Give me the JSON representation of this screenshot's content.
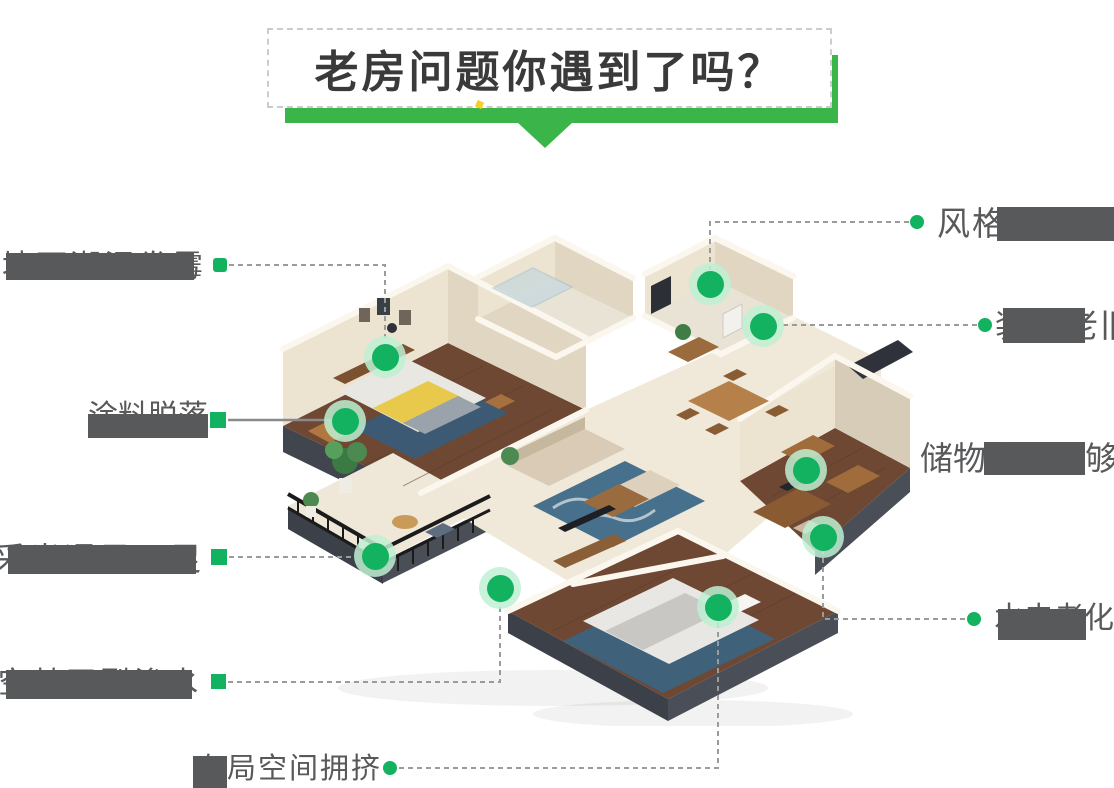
{
  "title": {
    "text": "老房问题你遇到了吗？"
  },
  "callouts": [
    {
      "id": "wall-mildew",
      "text": "墙面潮湿发霉",
      "visible_text": "霉",
      "state": "mostly-masked"
    },
    {
      "id": "paint-peeling",
      "text": "涂料脱落",
      "visible_text": "涂料脱落",
      "state": "bottom-half-masked"
    },
    {
      "id": "poor-lighting",
      "text": "采光通风不足",
      "visible_text": "采",
      "state": "mostly-masked"
    },
    {
      "id": "hollow-crack-seepage",
      "text": "空鼓开裂渗水",
      "visible_text": "空…水",
      "state": "mostly-masked"
    },
    {
      "id": "crowded-layout",
      "text": "布局空间拥挤",
      "visible_text": "布局空间拥挤",
      "state": "first-char-masked"
    },
    {
      "id": "outdated-style",
      "text": "风格过时",
      "visible_text": "风格",
      "state": "tail-masked"
    },
    {
      "id": "old-decoration",
      "text": "装修老旧",
      "visible_text": "旧",
      "state": "middle-masked"
    },
    {
      "id": "insufficient-storage",
      "text": "储物空间不够",
      "visible_text": "储物…够",
      "state": "middle-masked"
    },
    {
      "id": "aging-plumbing-wiring",
      "text": "水电老化",
      "visible_text": "化",
      "state": "mostly-masked"
    }
  ],
  "markers": [
    {
      "id": "bedroom-wall-spot",
      "x": 385,
      "y": 357
    },
    {
      "id": "bedroom-bedside-spot",
      "x": 345,
      "y": 421
    },
    {
      "id": "utility-room-spot",
      "x": 710,
      "y": 284
    },
    {
      "id": "entry-bath-spot",
      "x": 763,
      "y": 326
    },
    {
      "id": "bookshelf-spot",
      "x": 806,
      "y": 470
    },
    {
      "id": "study-desk-spot",
      "x": 823,
      "y": 537
    },
    {
      "id": "balcony-spot",
      "x": 375,
      "y": 556
    },
    {
      "id": "living-threshold-spot",
      "x": 500,
      "y": 588
    },
    {
      "id": "second-bedroom-spot",
      "x": 718,
      "y": 607
    }
  ],
  "colors": {
    "brand_green": "#3bb54a",
    "marker_green": "#12b260",
    "marker_halo": "#cdf2dc",
    "label_gray": "#58595b",
    "connector_gray": "#9b9b9b",
    "title_ink": "#3a3a3a",
    "accent_yellow": "#f3d02b"
  }
}
